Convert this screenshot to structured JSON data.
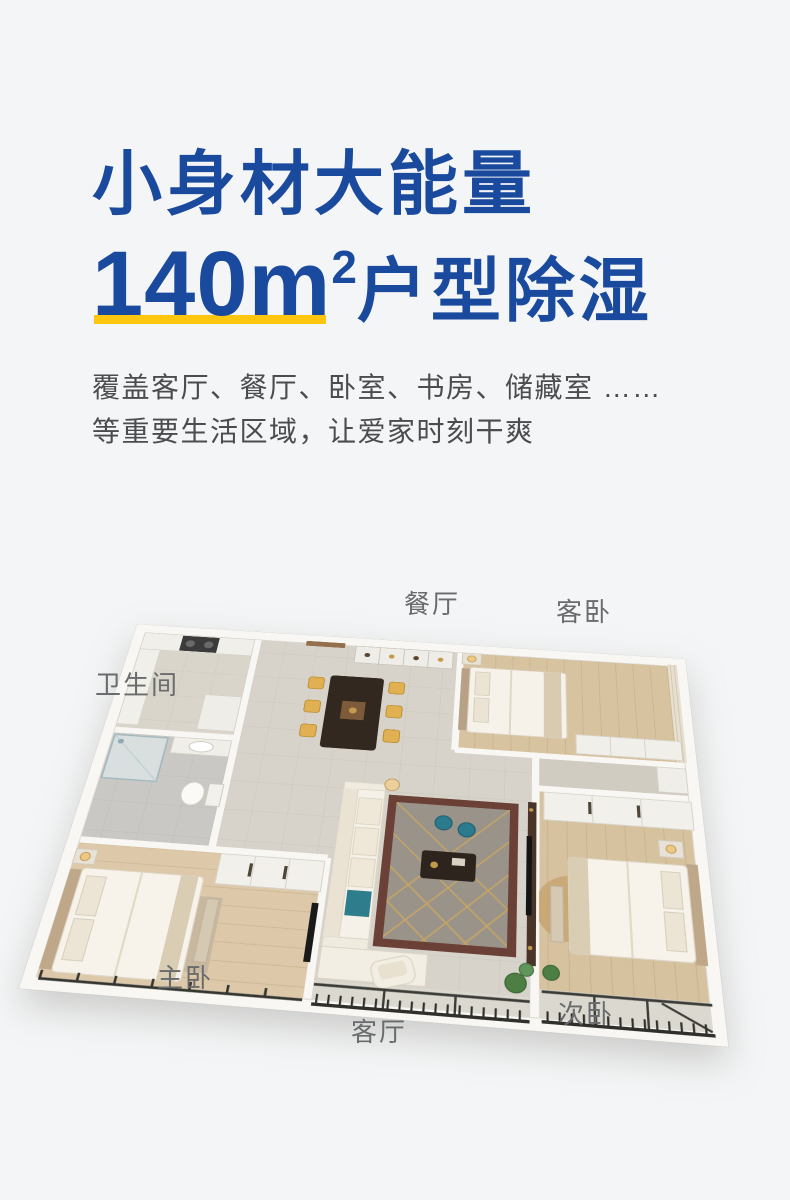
{
  "page": {
    "background_color": "#f4f5f6"
  },
  "hero": {
    "title_line1": "小身材大能量",
    "title_number": "140m",
    "title_exponent": "2",
    "title_line2_suffix": "户型除湿",
    "accent_blue": "#1a4a9d",
    "highlight_yellow": "#ffc60f",
    "subtitle_line1": "覆盖客厅、餐厅、卧室、书房、储藏室 ……",
    "subtitle_line2": "等重要生活区域，让爱家时刻干爽"
  },
  "floorplan": {
    "room_labels": {
      "dining": "餐厅",
      "guest_bedroom": "客卧",
      "bathroom": "卫生间",
      "master_bedroom": "主卧",
      "living_room": "客厅",
      "second_bedroom": "次卧"
    },
    "label_color": "#696b6d"
  }
}
